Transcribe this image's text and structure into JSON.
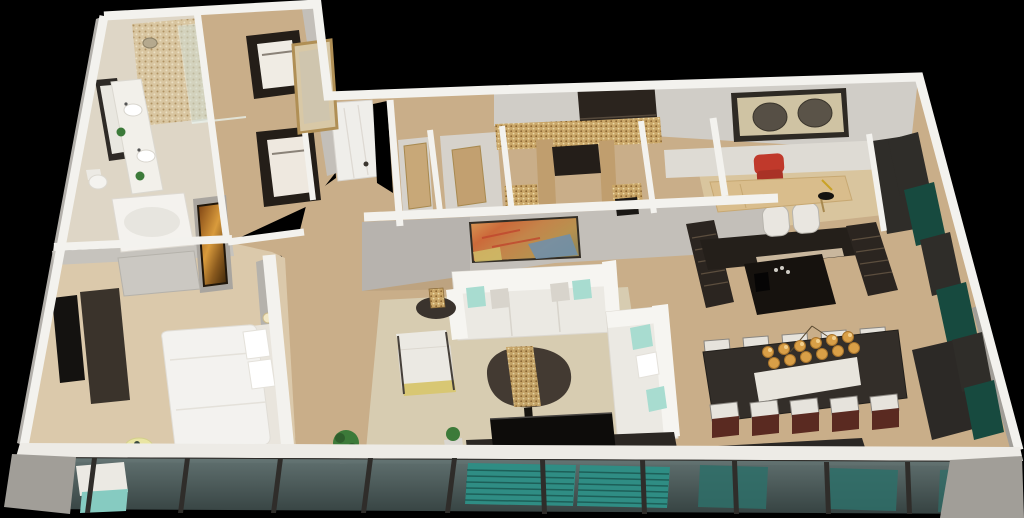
{
  "scene": {
    "description": "3D rendered aerial cutaway floor plan of an apartment on a black background: bathroom and walk-in closet at top left, bedroom at lower left, central living room, entry foyer with mosaic tile, home office at top right, dark kitchen island, dining table with globe chandelier at right, teal media-wall panels along the right wall, and a floor-to-ceiling window wall with teal louver screens across the bottom."
  },
  "colors": {
    "background": "#000000",
    "wallTop": "#f3f2ee",
    "wallFace": "#c3bfb9",
    "wallFaceLight": "#d6d2cb",
    "wallFaceDark": "#a9a59f",
    "concrete": "#a19e98",
    "tileFloor": "#ded6c6",
    "woodFloor": "#c9ae89",
    "carpet": "#dbc9ab",
    "rug": "#d7ccb1",
    "officeRug": "#d9c59e",
    "woodDoor": "#c8a878",
    "sofaWhite": "#ebe9e3",
    "cushionWhite": "#f6f5f1",
    "mint": "#a8dcd0",
    "pillowGray": "#d8d4cc",
    "darkWood": "#2b241e",
    "espresso": "#2b2520",
    "furnitureBlack": "#16120e",
    "charcoal": "#2f2d29",
    "tealPanel": "#174a3f",
    "tealLouver": "#2f8d84",
    "tealGlass": "#2e6e68",
    "tealChair": "#86cbc1",
    "glassTop": "#6b7d7c",
    "glassBottom": "#3c4a49",
    "sillWhite": "#edebe6",
    "amberBulb": "#d99f47",
    "redChair": "#c0392b",
    "chairFrameRed": "#5a2a21",
    "artAmber": "#d99b3c",
    "mosaicGold": "#c9a668",
    "tableYellow": "#e9e5a3",
    "plantGreen": "#3c7a39",
    "benchGray": "#cbc8c2",
    "accentYellow": "#d8c773",
    "diningTable": "#332e29",
    "mediaConsole": "#3a332b"
  },
  "rooms": [
    {
      "name": "bathroom",
      "items": [
        "double-vanity",
        "leaning-mirror",
        "bathtub",
        "walk-in-shower",
        "toilet",
        "plants"
      ]
    },
    {
      "name": "walk-in-closet",
      "items": [
        "dark-wardrobes",
        "gold-leaning-mirror",
        "white-door"
      ]
    },
    {
      "name": "bedroom",
      "items": [
        "bed",
        "upholstered-bench",
        "tv",
        "media-console",
        "yellow-side-table",
        "window-lounge-chair",
        "amber-wall-art"
      ]
    },
    {
      "name": "hallway",
      "items": [
        "wood-doors",
        "storage-rooms"
      ]
    },
    {
      "name": "foyer",
      "items": [
        "floating-cabinet",
        "mosaic-tile-walls",
        "base-cabinet",
        "wood-panels"
      ]
    },
    {
      "name": "living-room",
      "items": [
        "sofa",
        "second-sofa",
        "armchair",
        "pebble-coffee-table",
        "side-table-lamp",
        "tv-console",
        "abstract-painting",
        "potted-plants"
      ]
    },
    {
      "name": "home-office",
      "items": [
        "wood-desk",
        "red-chair",
        "two-circle-artwork",
        "desk-lamp",
        "dark-cabinet"
      ]
    },
    {
      "name": "kitchen",
      "items": [
        "dark-island",
        "slatted-panels",
        "bar-stools",
        "coffee-machine"
      ]
    },
    {
      "name": "dining-area",
      "items": [
        "dark-dining-table",
        "white-runner",
        "globe-chandelier",
        "ten-chairs"
      ]
    },
    {
      "name": "media-wall",
      "items": [
        "teal-panels",
        "charcoal-panels",
        "dark-floor-panel"
      ]
    },
    {
      "name": "window-wall",
      "items": [
        "floor-to-ceiling-glass",
        "teal-louver-screens",
        "dark-mullions",
        "white-sill",
        "concrete-corners"
      ]
    }
  ]
}
